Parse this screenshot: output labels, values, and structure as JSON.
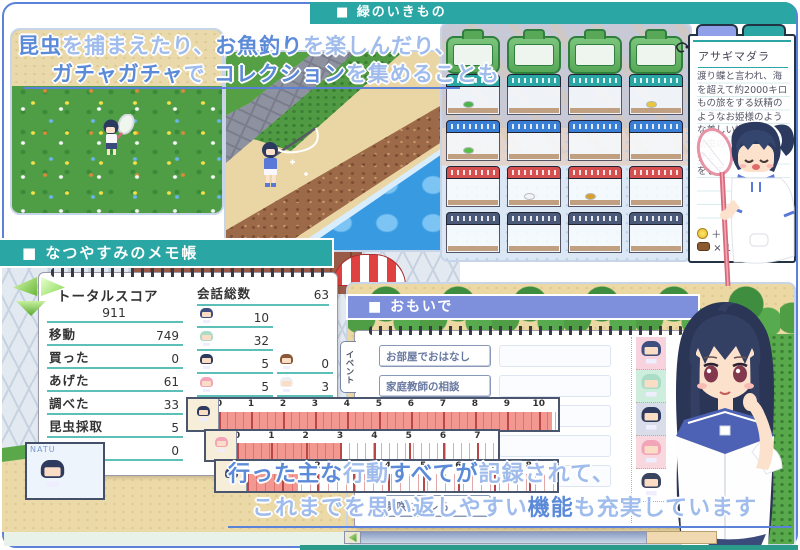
{
  "colors": {
    "teal_header": "#2aa6a4",
    "periwinkle_header": "#7e90dc",
    "frame_blue": "#5b82d8",
    "text_emphasis": "#5b8ad8",
    "text_light": "#9fbcec",
    "meter_fill": "#f29890",
    "underline_teal": "#5cc0b8"
  },
  "headers": {
    "creatures": "■ 緑のいきもの",
    "notepad": "■ なつやすみのメモ帳",
    "memories": "■ おもいで"
  },
  "banner": {
    "line1": [
      {
        "text": "昆虫",
        "em": true
      },
      {
        "text": "を捕まえたり、",
        "em": false
      },
      {
        "text": "お魚釣り",
        "em": true
      },
      {
        "text": "を楽しんだり、",
        "em": false
      }
    ],
    "line2": [
      {
        "text": "ガチャガチャ",
        "em": true
      },
      {
        "text": "で ",
        "em": false
      },
      {
        "text": "コレクション",
        "em": true
      },
      {
        "text": "を集めることも",
        "em": false
      }
    ]
  },
  "encyclopedia": {
    "title": "アサギマダラ",
    "description_lines": [
      "渡り蝶と言われ、海",
      "を超えて約2000キロ",
      "もの旅をする妖精の",
      "ようなお姫様のよう",
      "な美しい蝶。",
      "幼虫の",
      "グミ",
      "をして"
    ],
    "reward_coin": "＋",
    "reward_item": "× 1"
  },
  "score": {
    "total_label": "トータルスコア",
    "total_value": "911",
    "stats": [
      {
        "label": "移動",
        "value": "749"
      },
      {
        "label": "買った",
        "value": "0"
      },
      {
        "label": "あげた",
        "value": "61"
      },
      {
        "label": "調べた",
        "value": "33"
      },
      {
        "label": "昆虫採取",
        "value": "5"
      },
      {
        "label": "釣り",
        "value": "0"
      }
    ],
    "conversation": {
      "label": "会話総数",
      "total": "63",
      "col1": [
        {
          "value": "10",
          "hair": "#3e4e7e"
        },
        {
          "value": "32",
          "hair": "#aadcc8"
        },
        {
          "value": "5",
          "hair": "#2e3a5e"
        },
        {
          "value": "5",
          "hair": "#f2a4b8"
        },
        {
          "value": "8",
          "hair": "#4a4468"
        }
      ],
      "col2": [
        {
          "value": "0",
          "hair": "#8a5838"
        },
        {
          "value": "3",
          "hair": "#eceef2"
        },
        {
          "value": "0",
          "hair": "#39445f"
        }
      ]
    }
  },
  "meters": [
    {
      "hair": "#2e3a5e",
      "ticks": [
        "0",
        "1",
        "2",
        "3",
        "4",
        "5",
        "6",
        "7",
        "8",
        "9",
        "10"
      ],
      "max": 10.6,
      "value": 10.4,
      "minor_px": 8
    },
    {
      "hair": "#f2a4b8",
      "ticks": [
        "0",
        "1",
        "2",
        "3",
        "4",
        "5",
        "6",
        "7"
      ],
      "max": 7.6,
      "value": 3,
      "minor_px": 8
    },
    {
      "hair": "#3e4e7e",
      "ticks": [
        "0",
        "1",
        "2",
        "3",
        "4",
        "5",
        "6",
        "7",
        "8"
      ],
      "max": 8.8,
      "value": 1.45,
      "minor_px": 9
    }
  ],
  "natu": {
    "label": "NATU",
    "hair": "#2e3a5e"
  },
  "memories": {
    "tabs": [
      {
        "label": "イベント"
      },
      {
        "label": "エッチ"
      }
    ],
    "items": [
      {
        "label": "お部屋でおはなし"
      },
      {
        "label": "家庭教師の相談"
      },
      {
        "label": "お化け？"
      },
      {
        "label": "葵とガチャ"
      },
      {
        "label": "ポニーテール"
      },
      {
        "label": "美咲にバレる"
      }
    ],
    "portraits": [
      {
        "bg": "#f8d2dc",
        "hair": "#3e4e7e"
      },
      {
        "bg": "#cdeedd",
        "hair": "#aadcc8"
      },
      {
        "bg": "#d9dde9",
        "hair": "#2e3a5e"
      },
      {
        "bg": "#f8d8de",
        "hair": "#f2a4b8"
      },
      {
        "bg": "#ffffff",
        "hair": "#39445f"
      }
    ]
  },
  "footer": {
    "line1": [
      {
        "text": "行った主な",
        "em": true
      },
      {
        "text": "行動",
        "em": false
      },
      {
        "text": "すべてが",
        "em": true
      },
      {
        "text": "記録されて、",
        "em": false
      }
    ],
    "line2": [
      {
        "text": "これまでを思い返しやすい",
        "em": false
      },
      {
        "text": "機能",
        "em": true
      },
      {
        "text": "も充実しています",
        "em": false
      }
    ]
  },
  "cages": {
    "rows": [
      {
        "type": "case",
        "lid": "#58a858",
        "cells": [
          {},
          {},
          {},
          {}
        ]
      },
      {
        "type": "tank",
        "lid": "#2aa6a4",
        "cells": [
          {
            "bug": "#4ab44a"
          },
          {},
          {},
          {
            "bug": "#e8c83a"
          }
        ]
      },
      {
        "type": "tank",
        "lid": "#3a7fd6",
        "cells": [
          {
            "bug": "#58c048"
          },
          {},
          {},
          {}
        ]
      },
      {
        "type": "tank",
        "lid": "#d65050",
        "cells": [
          {},
          {
            "bug": "#f4f4f8"
          },
          {
            "bug": "#d8a030"
          },
          {}
        ]
      },
      {
        "type": "tank",
        "lid": "#4a5a78",
        "cells": [
          {},
          {},
          {},
          {}
        ]
      }
    ]
  }
}
